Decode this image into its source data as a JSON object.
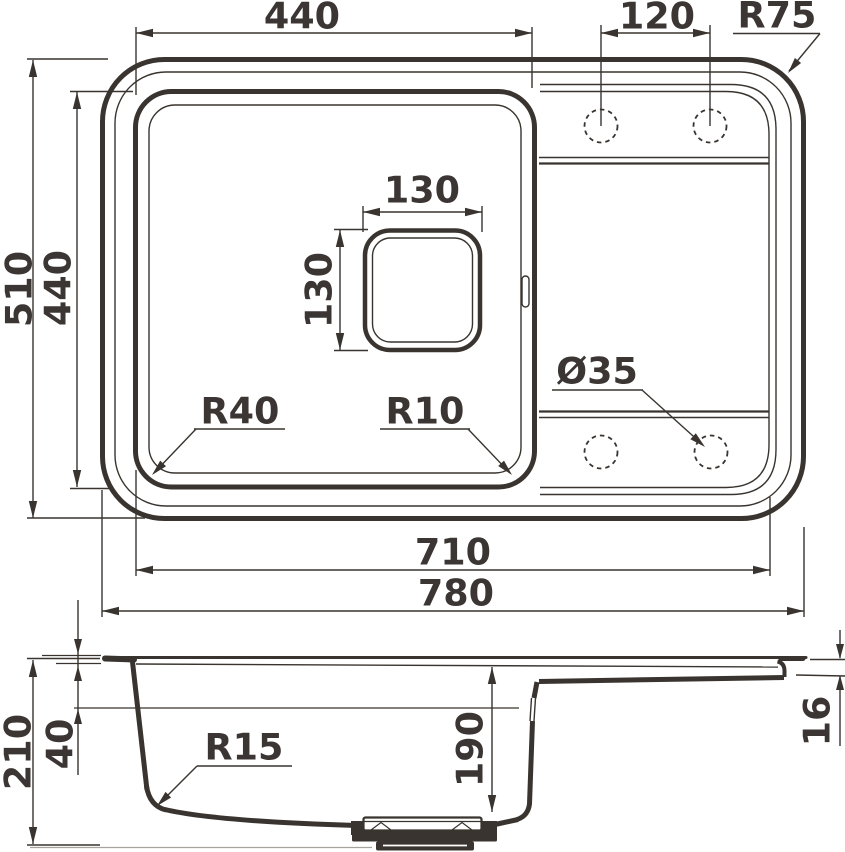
{
  "drawing": {
    "description": "Kitchen sink dimensional drawing, top view and section view",
    "top_view": {
      "bowl_width": "440",
      "faucet_hole_spacing": "120",
      "outer_corner_radius": "R75",
      "overall_depth": "510",
      "bowl_depth": "440",
      "drain_square_width": "130",
      "drain_square_height": "130",
      "bowl_corner_radius": "R40",
      "bowl_inner_radius": "R10",
      "faucet_hole_diameter": "Ø35",
      "inner_width": "710",
      "overall_width": "780"
    },
    "side_view": {
      "overall_height": "210",
      "ledge_depth": "40",
      "bottom_corner_radius": "R15",
      "bowl_inner_depth": "190",
      "rim_step_height": "16"
    },
    "colors": {
      "ink": "#39342f",
      "faint": "#a6a29e",
      "background": "#ffffff"
    }
  }
}
